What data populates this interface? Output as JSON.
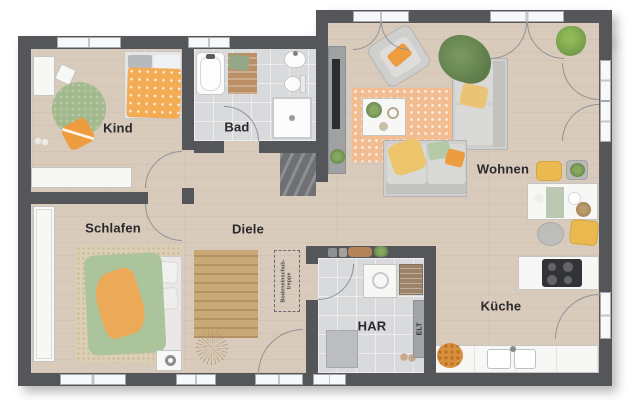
{
  "rooms": {
    "kind": {
      "label": "Kind"
    },
    "bad": {
      "label": "Bad"
    },
    "wohnen": {
      "label": "Wohnen"
    },
    "schlafen": {
      "label": "Schlafen"
    },
    "diele": {
      "label": "Diele"
    },
    "har": {
      "label": "HAR"
    },
    "kueche": {
      "label": "Küche"
    }
  },
  "annotations": {
    "elt_panel": {
      "label": "ELT"
    },
    "attic_stairs": {
      "label": "Bodeneinschub-treppe"
    }
  },
  "colors": {
    "wall": "#55565a",
    "wood_floor": "#d9cbbc",
    "tile_floor": "#d8dadc",
    "accent_orange": "#ee9c40",
    "accent_green": "#abc49c",
    "rug_orange": "#f3bd92"
  }
}
